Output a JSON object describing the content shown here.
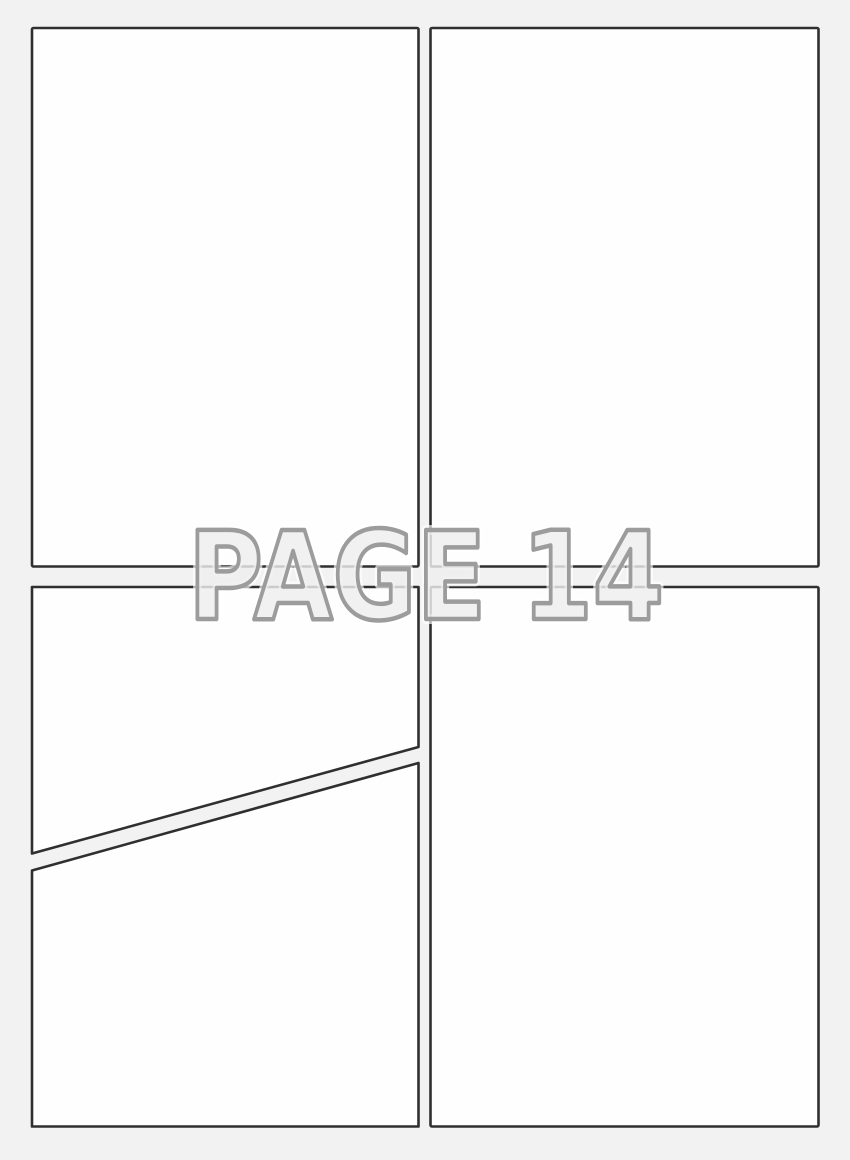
{
  "page": {
    "kind": "comic-page-template",
    "watermark": {
      "label": "PAGE 14"
    },
    "colors": {
      "background": "#f2f2f2",
      "panel_fill": "#fefefe",
      "panel_border": "#2f2f2f",
      "watermark_fill": "rgba(238,238,238,0.82)",
      "watermark_outline": "#9c9c9c",
      "watermark_halo": "rgba(255,255,255,0.65)"
    },
    "panels": [
      {
        "id": "panel-top-left"
      },
      {
        "id": "panel-top-right"
      },
      {
        "id": "panel-bottom-left-upper"
      },
      {
        "id": "panel-bottom-left-lower"
      },
      {
        "id": "panel-bottom-right"
      }
    ]
  }
}
